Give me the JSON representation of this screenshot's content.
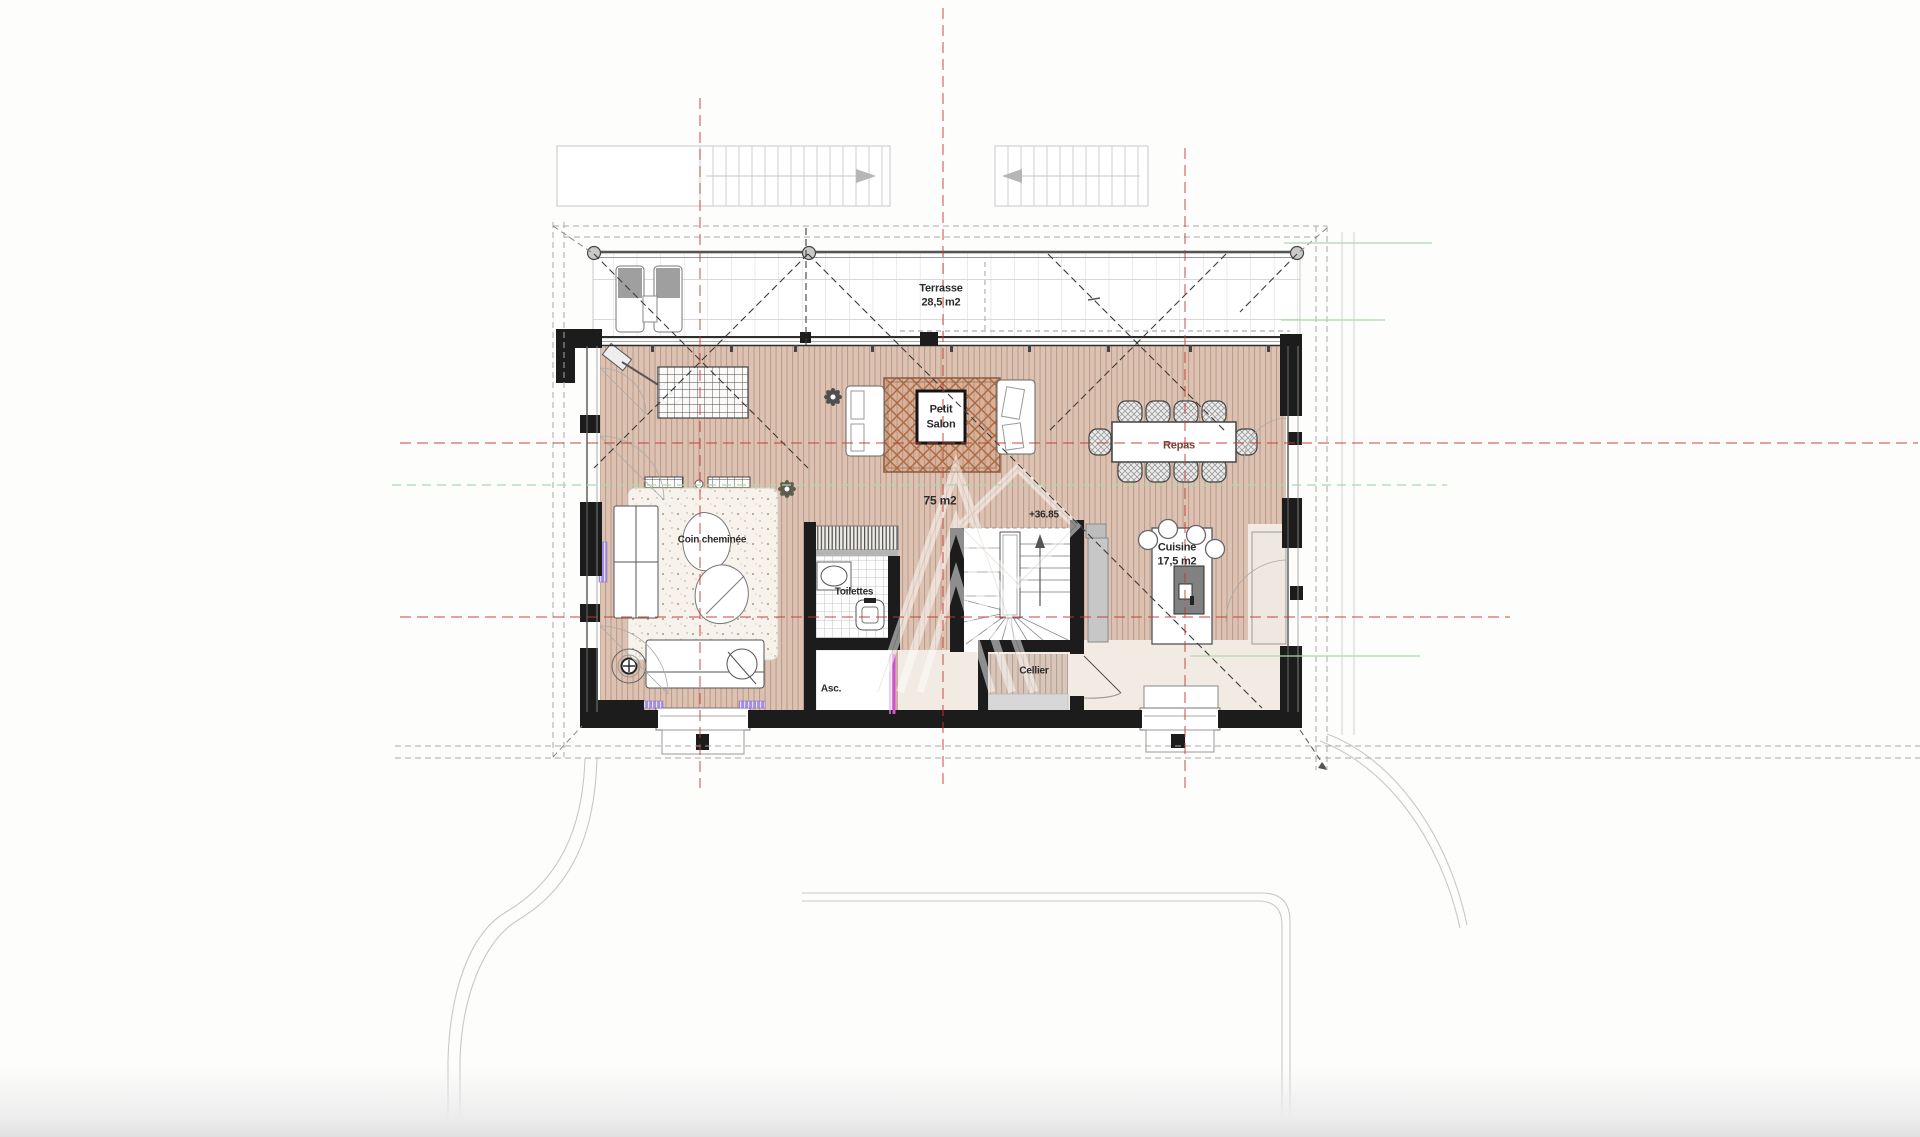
{
  "plan": {
    "title": "floor-plan",
    "labels": {
      "terrasse": "Terrasse",
      "terrasse_area": "28,5 m2",
      "petit_salon_line1": "Petit",
      "petit_salon_line2": "Salon",
      "repas": "Repas",
      "area_total": "75 m2",
      "level": "+36.85",
      "coin_cheminee": "Coin cheminée",
      "toilettes": "Toilettes",
      "cuisine": "Cuisine",
      "cuisine_area": "17,5 m2",
      "cellier": "Cellier",
      "ascenseur": "Asc."
    },
    "colors": {
      "axis_red": "#c4392f",
      "axis_green": "#abd9ab",
      "door_magenta": "#d14fd1",
      "radiator_purple": "#8f7fe8",
      "wood_floor": "#dcc2b2",
      "kitchen_floor": "#f2ebe3",
      "wall_black": "#1c1c1c",
      "label_red": "#7d4438"
    }
  }
}
